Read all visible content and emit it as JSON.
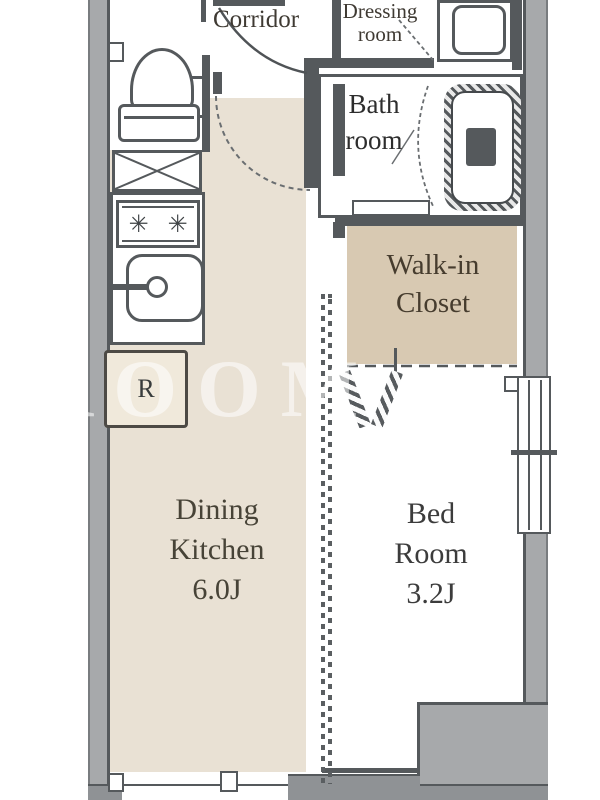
{
  "rooms": {
    "corridor": "Corridor",
    "dressing": [
      "Dressing",
      "room"
    ],
    "bath": [
      "Bath",
      "room"
    ],
    "wic": [
      "Walk-in",
      "Closet"
    ],
    "dk": [
      "Dining",
      "Kitchen",
      "6.0J"
    ],
    "bed": [
      "Bed",
      "Room",
      "3.2J"
    ]
  },
  "fixtures": {
    "fridge_label": "R",
    "burner_glyph": "✳"
  },
  "watermark": {
    "text": "ROOM",
    "fragment": "V"
  },
  "colors": {
    "dk_floor": "#e9e1d4",
    "closet_floor": "#d8c9b2",
    "wall_dark": "#55595c",
    "outside_gray": "#a7a9ab",
    "bottom_wall_gray": "#8f9295",
    "fridge_fill": "#f0e9db",
    "label_text": "#3f3a33",
    "watermark_white": "rgba(255,255,255,0.55)"
  }
}
